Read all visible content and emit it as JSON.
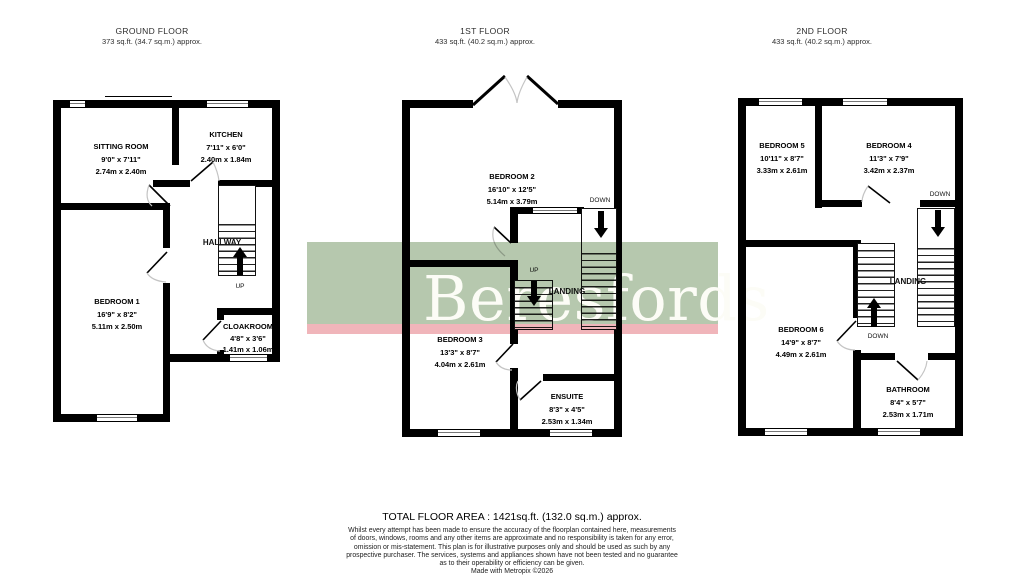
{
  "floors": [
    {
      "title": "GROUND FLOOR",
      "area": "373 sq.ft. (34.7 sq.m.) approx.",
      "rooms": [
        {
          "name": "SITTING ROOM",
          "imperial": "9'0\" x 7'11\"",
          "metric": "2.74m x 2.40m"
        },
        {
          "name": "KITCHEN",
          "imperial": "7'11\" x 6'0\"",
          "metric": "2.40m x 1.84m"
        },
        {
          "name": "BEDROOM 1",
          "imperial": "16'9\" x 8'2\"",
          "metric": "5.11m x 2.50m"
        },
        {
          "name": "CLOAKROOM",
          "imperial": "4'8\" x 3'6\"",
          "metric": "1.41m x 1.06m"
        }
      ],
      "labels": {
        "hallway": "HALLWAY",
        "up": "UP"
      }
    },
    {
      "title": "1ST FLOOR",
      "area": "433 sq.ft. (40.2 sq.m.) approx.",
      "rooms": [
        {
          "name": "BEDROOM 2",
          "imperial": "16'10\" x 12'5\"",
          "metric": "5.14m x 3.79m"
        },
        {
          "name": "BEDROOM 3",
          "imperial": "13'3\" x 8'7\"",
          "metric": "4.04m x 2.61m"
        },
        {
          "name": "ENSUITE",
          "imperial": "8'3\" x 4'5\"",
          "metric": "2.53m x 1.34m"
        }
      ],
      "labels": {
        "landing": "LANDING",
        "up": "UP",
        "down": "DOWN"
      }
    },
    {
      "title": "2ND FLOOR",
      "area": "433 sq.ft. (40.2 sq.m.) approx.",
      "rooms": [
        {
          "name": "BEDROOM 5",
          "imperial": "10'11\" x 8'7\"",
          "metric": "3.33m x 2.61m"
        },
        {
          "name": "BEDROOM 4",
          "imperial": "11'3\" x 7'9\"",
          "metric": "3.42m x 2.37m"
        },
        {
          "name": "BEDROOM 6",
          "imperial": "14'9\" x 8'7\"",
          "metric": "4.49m x 2.61m"
        },
        {
          "name": "BATHROOM",
          "imperial": "8'4\" x 5'7\"",
          "metric": "2.53m x 1.71m"
        }
      ],
      "labels": {
        "landing": "LANDING",
        "down_left": "DOWN",
        "down_right": "DOWN"
      }
    }
  ],
  "watermark": {
    "text": "Beresfords",
    "green": "#b6c8ae",
    "pink": "#f0b5ba"
  },
  "footer": {
    "total": "TOTAL FLOOR AREA : 1421sq.ft. (132.0 sq.m.) approx.",
    "disclaimer": [
      "Whilst every attempt has been made to ensure the accuracy of the floorplan contained here, measurements",
      "of doors, windows, rooms and any other items are approximate and no responsibility is taken for any error,",
      "omission or mis-statement. This plan is for illustrative purposes only and should be used as such by any",
      "prospective purchaser. The services, systems and appliances shown have not been tested and no guarantee",
      "as to their operability or efficiency can be given.",
      "Made with Metropix ©2026"
    ]
  }
}
